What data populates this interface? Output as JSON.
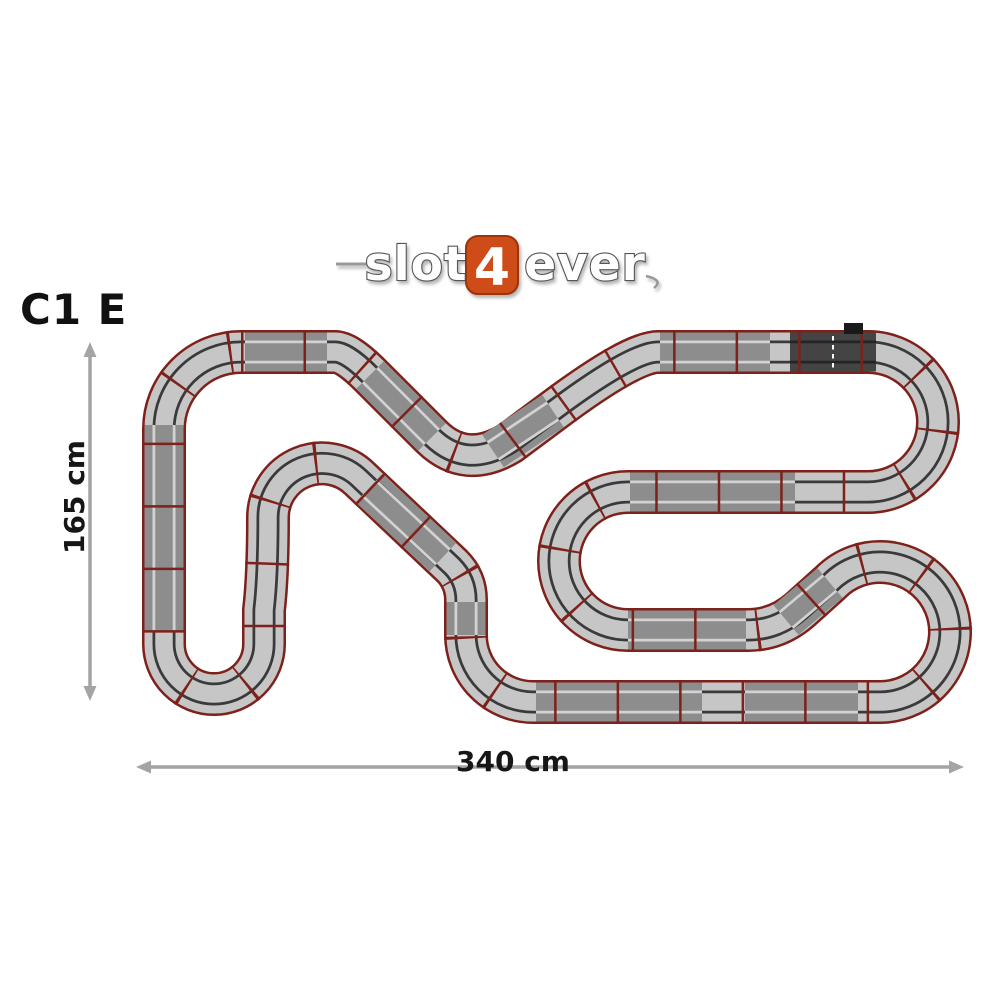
{
  "page": {
    "background": "#ffffff"
  },
  "header": {
    "layout_code": "C1 E",
    "logo": {
      "part1": "slot",
      "number": "4",
      "part2": "ever",
      "accent_color": "#cd4c18",
      "accent_edge": "#993508"
    }
  },
  "dimensions": {
    "height_label": "165 cm",
    "width_label": "340 cm",
    "arrow_color": "#a4a4a4"
  },
  "track": {
    "colors": {
      "border": "#7d211a",
      "separator": "#7d211a",
      "light": "#c6c6c6",
      "mid": "#8d8d8d",
      "dark": "#444444",
      "slot_on_light": "#3a3a3a",
      "slot_on_mid": "#d2d2d2",
      "slot_on_dark": "#242424",
      "start_line": "#ffffff",
      "connector": "#1a1a1a"
    },
    "widths": {
      "border": 44,
      "bed": 39,
      "slot": 23,
      "cover": 17.5
    },
    "separator_dash": "2.5 60",
    "path": "M 241 352 L 335 352 Q 347 352 370 375 L 432 437 Q 466 470 510 443 L 553 411 Q 632 352 658 352 L 868 352 A 70 70 0 1 1 868 492 L 628 492 A 69 69 0 1 0 628 630 L 748 630 Q 777 630 800 610 L 830 583 A 70 70 0 1 1 879 702 L 533 702 A 67 67 0 0 1 466 635 L 466 600 Q 466 580 452 566 L 360 479 A 54 54 0 0 0 268 517 Q 268 575 264 610 L 264 644 A 50 50 0 1 1 164 644 L 164 429 A 77 77 0 0 1 241 352 Z",
    "segments_mid": [
      "M 245 352 L 327 352",
      "M 370 375 L 432 437",
      "M 493 451 L 553 411",
      "M 660 352 L 770 352",
      "M 630 492 L 795 492",
      "M 628 630 L 746 630",
      "M 786 620 L 830 583",
      "M 536 702 L 702 702",
      "M 745 702 L 858 702",
      "M 164 425 L 164 632",
      "M 443 557 L 369 488",
      "M 466 635 L 466 602"
    ],
    "segments_dark": [
      "M 790 352 L 876 352"
    ],
    "start_finish": {
      "line_x": 833,
      "line_y1": 336,
      "line_y2": 370,
      "connector": {
        "x": 844,
        "y": 323,
        "w": 19,
        "h": 11
      }
    }
  }
}
